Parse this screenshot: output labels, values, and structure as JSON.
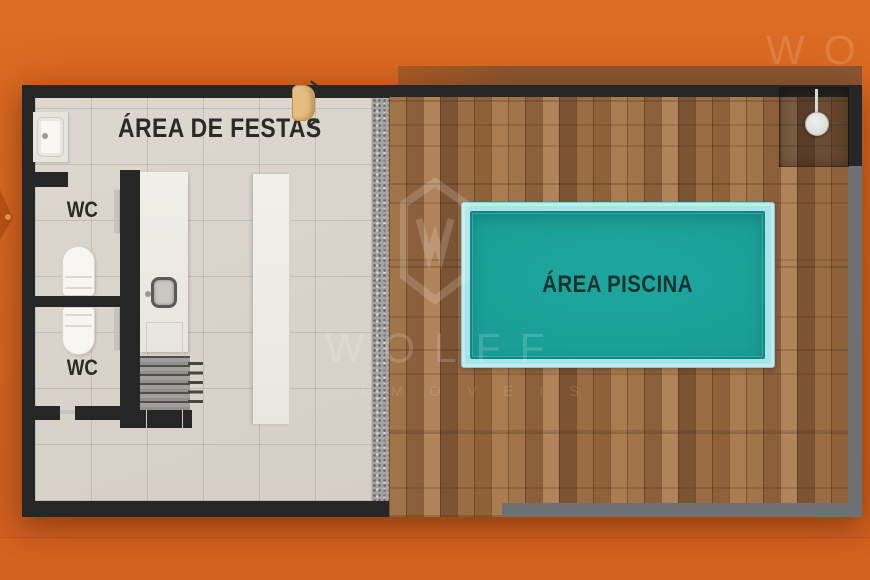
{
  "title": "floor-plan-area-de-lazer",
  "labels": {
    "festas": "ÁREA DE FESTAS",
    "wc": "WC",
    "piscina": "ÁREA PISCINA"
  },
  "watermark": {
    "brand": "WOLFF",
    "brand_partial": "WO",
    "subtitle": "IMÓVEIS"
  },
  "colors": {
    "background_orange": "#d6651f",
    "wall_black": "#262626",
    "wall_gray": "#6f7071",
    "tile_floor": "#d9d3cb",
    "gravel_strip": "#a5a4a0",
    "wood_deck": "#9a6d44",
    "pool_water": "#1aa19a",
    "pool_coping": "#a9e3eb",
    "chair_tan": "#e6bd81",
    "fixture_white": "#f7f6f3"
  }
}
